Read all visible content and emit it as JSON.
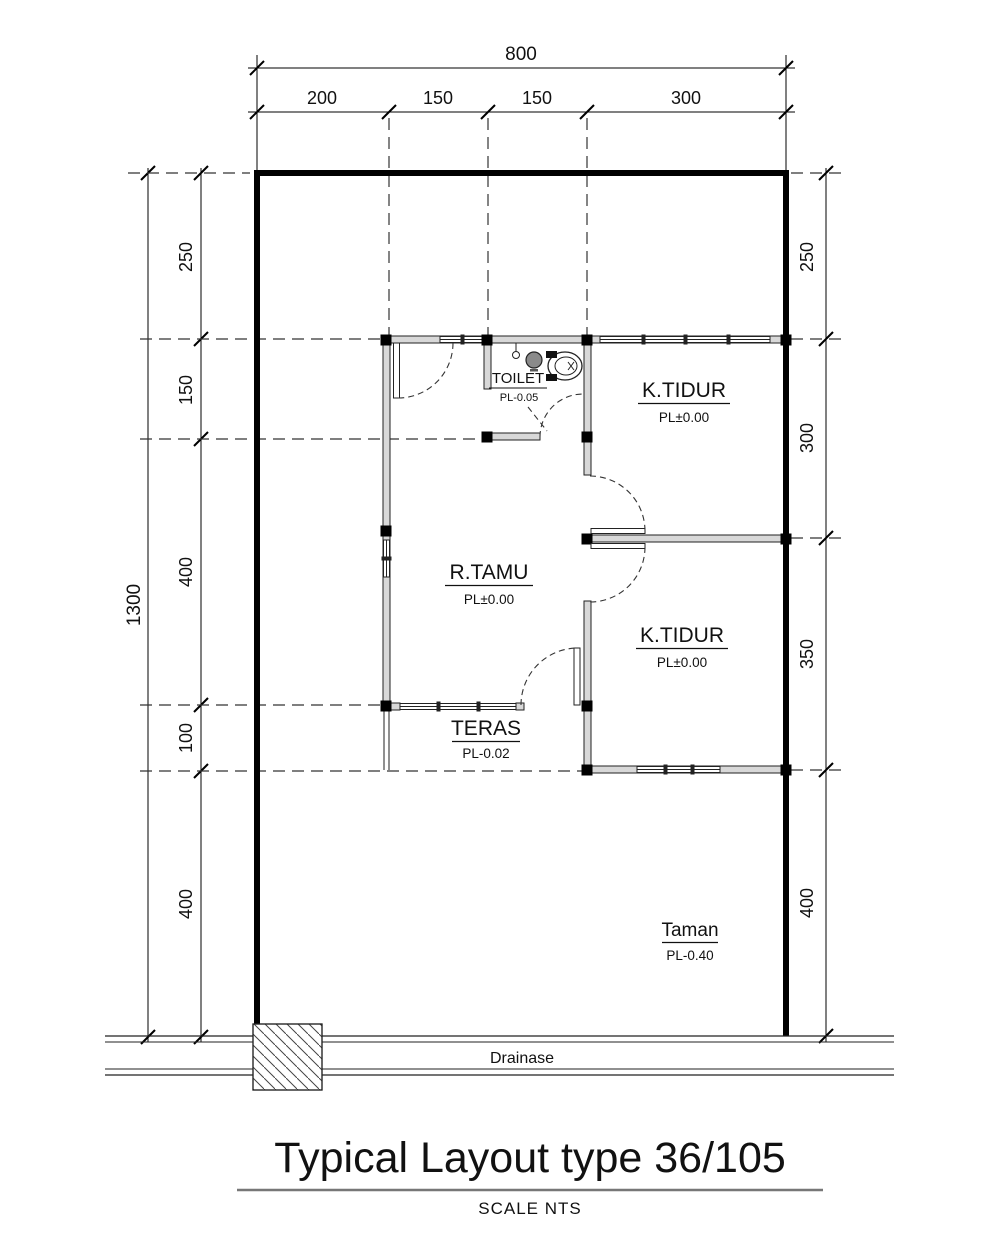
{
  "drawing": {
    "title": "Typical Layout type 36/105",
    "scale_note": "SCALE NTS"
  },
  "dimensions": {
    "top": {
      "overall": "800",
      "seg": [
        "200",
        "150",
        "150",
        "300"
      ]
    },
    "left": {
      "overall": "1300",
      "seg": [
        "250",
        "150",
        "400",
        "100",
        "400"
      ]
    },
    "right": {
      "seg": [
        "250",
        "300",
        "350",
        "400"
      ]
    }
  },
  "rooms": {
    "toilet": {
      "name": "TOILET",
      "level": "PL-0.05"
    },
    "bedroom1": {
      "name": "K.TIDUR",
      "level": "PL±0.00"
    },
    "living": {
      "name": "R.TAMU",
      "level": "PL±0.00"
    },
    "bedroom2": {
      "name": "K.TIDUR",
      "level": "PL±0.00"
    },
    "terrace": {
      "name": "TERAS",
      "level": "PL-0.02"
    },
    "garden": {
      "name": "Taman",
      "level": "PL-0.40"
    }
  },
  "site": {
    "drainage_label": "Drainase"
  },
  "colors": {
    "line": "#000000",
    "wall_fill": "#d8d8d8"
  }
}
